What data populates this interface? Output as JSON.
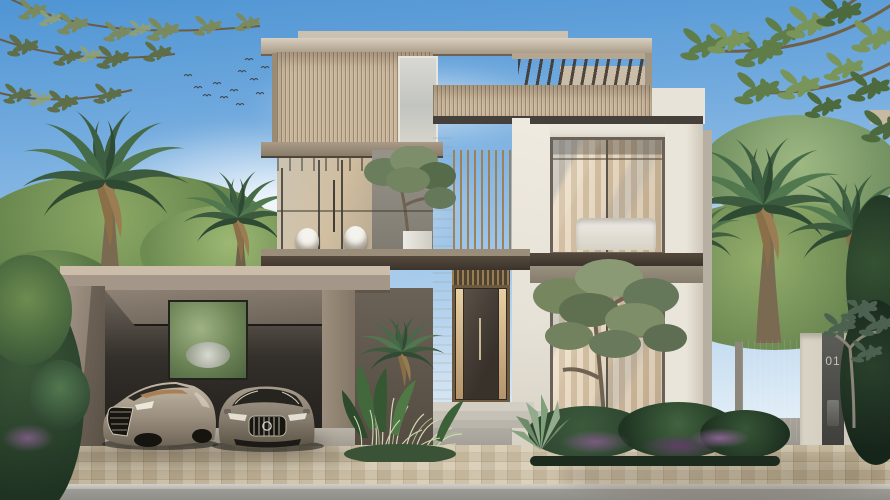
{
  "scene": {
    "title": "Modern two-storey luxury villa exterior rendering",
    "villa_number": "01",
    "setting": "Daytime, clear blue sky with soft clouds and a flock of birds",
    "objects": [
      "two-storey modern villa with wood-slat facade and rooftop pergola",
      "second-floor balcony with glass railing, two white wicker chairs and potted olive tree",
      "double-height entrance with bronze louvers and dark front door",
      "open carport with two champagne-bronze luxury cars",
      "date palm trees and olive trees",
      "tropical planting beds with purple ground flowers and grasses",
      "tan mosaic paver driveway and grey street",
      "dark metal garden gate and stone pillar numbered 01"
    ]
  },
  "colors": {
    "sky_top": "#4f95d4",
    "sky_horizon": "#e9f2f8",
    "stucco": "#e7e2d8",
    "wood_slat": "#c8b59a",
    "roof": "#a79a86",
    "carport": "#a4978a",
    "fascia_dark": "#46403a",
    "glass_warm": "#c7b298",
    "bronze": "#a08155",
    "paver": "#cfc0a2",
    "road": "#9e9c97",
    "foliage_dark": "#2c432f",
    "foliage_mid": "#52784f",
    "foliage_light": "#8ca865",
    "olive_leaf": "#7a8a5e",
    "flower_purple": "#7a5a80",
    "car_left": "#a3988a",
    "car_right": "#847a6c",
    "gate_metal": "#3a3a38",
    "pillar_stone": "#cfc9bb"
  }
}
